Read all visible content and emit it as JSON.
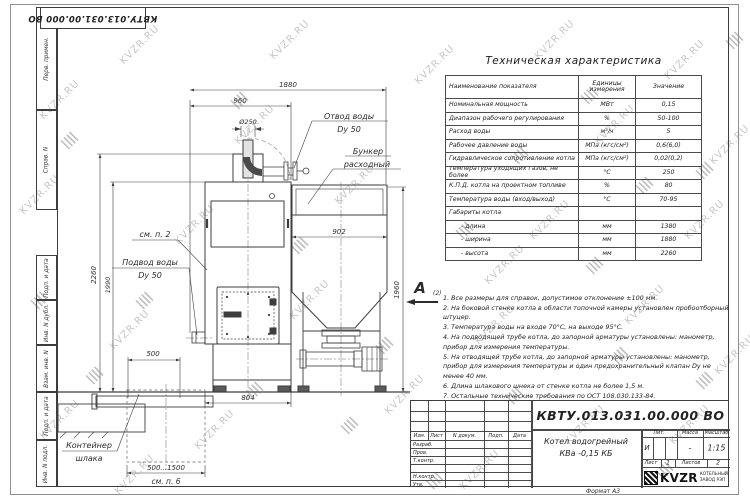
{
  "frame": {
    "doc_number_top": "КВТУ.013.031.00.000 ВО",
    "left_strip_top": [
      "Перв. примен.",
      "Справ. N"
    ],
    "left_strip_bottom": [
      "Подп. и дата",
      "Инв. N дубл.",
      "Взам. инв. N",
      "Подп. и дата",
      "Инв. N подл."
    ],
    "format_label": "Формат А3"
  },
  "watermark": {
    "text": "KVZR.RU"
  },
  "spec_table": {
    "title": "Техническая характеристика",
    "headers": {
      "name": "Наименование показателя",
      "unit": "Единицы измерения",
      "value": "Значение"
    },
    "rows": [
      {
        "name": "Номинальная мощность",
        "unit": "МВт",
        "value": "0,15"
      },
      {
        "name": "Диапазон рабочего регулирования",
        "unit": "%",
        "value": "50-100"
      },
      {
        "name": "Расход воды",
        "unit": "м³/ч",
        "value": "5"
      },
      {
        "name": "Рабочее давление воды",
        "unit": "МПа (кгс/см²)",
        "value": "0,6(6,0)"
      },
      {
        "name": "Гидравлическое сопротивление котла",
        "unit": "МПа (кгс/см²)",
        "value": "0,02(0,2)"
      },
      {
        "name": "Температура уходящих газов, не более",
        "unit": "°С",
        "value": "250"
      },
      {
        "name": "К.П.Д. котла на проектном топливе",
        "unit": "%",
        "value": "80"
      },
      {
        "name": "Температура воды (вход/выход)",
        "unit": "°С",
        "value": "70-95"
      },
      {
        "name": "Габариты котла",
        "unit": "",
        "value": ""
      },
      {
        "name": "- длина",
        "unit": "мм",
        "value": "1380"
      },
      {
        "name": "- ширина",
        "unit": "мм",
        "value": "1880"
      },
      {
        "name": "- высота",
        "unit": "мм",
        "value": "2260"
      }
    ]
  },
  "notes": {
    "items": [
      "1.  Все размеры для справок, допустимое отклонение  ±100 мм.",
      "2.  На боковой стенке котла в области топочной камеры установлен пробоотборный штуцер.",
      "3.  Температура воды на входе  70°С, на выходе  95°С.",
      "4.  На подводящей трубе котла, до запорной арматуры установлены: манометр, прибор для измерения температуры.",
      "5.  На отводящей трубе котла, до запорной арматуры установлены: манометр, прибор для измерения температуры и один предохранительный клапан Dy не менее  40 мм.",
      "6.  Длина шлакового шнека от стенке котла не более  1,5 м.",
      "7.  Остальные технические требования по ОСТ  108.030.133-84."
    ]
  },
  "view_marker": {
    "letter": "А",
    "sub": "(2)"
  },
  "drawing": {
    "dims": {
      "overall_length": "1880",
      "top_length": "960",
      "chimney_dia": "Ø250",
      "bunker_width": "902",
      "bunker_height": "1960",
      "overall_height": "2260",
      "boiler_height": "1990",
      "container_width": "500",
      "boiler_base_length": "804",
      "container_range": "500...1500"
    },
    "labels": {
      "outlet_line1": "Отвод воды",
      "outlet_line2": "Dy 50",
      "bunker_line1": "Бункер",
      "bunker_line2": "расходный",
      "see_note_2": "см. п. 2",
      "inlet_line1": "Подвод воды",
      "inlet_line2": "Dy 50",
      "container_line1": "Контейнер",
      "container_line2": "шлака",
      "see_note_6": "см. п. 6"
    }
  },
  "title_block": {
    "doc_number": "КВТУ.013.031.00.000  ВО",
    "product_line1": "Котел водогрейный",
    "product_line2": "КВа -0,15  КБ",
    "cols": {
      "izm": "Изм.",
      "list": "Лист",
      "n_doc": "N докум.",
      "podp": "Подп.",
      "data": "Дата"
    },
    "rows": [
      "Разраб.",
      "Пров.",
      "Т.контр.",
      "",
      "Н.контр.",
      "Утв."
    ],
    "lit_label": "Лит.",
    "mass_label": "Масса",
    "scale_label": "Масштаб",
    "lit_value": "И",
    "mass_value": "-",
    "scale_value": "1:15",
    "sheet_label": "Лист",
    "sheet_value": "1",
    "sheets_label": "Листов",
    "sheets_value": "2",
    "logo_text": "KVZR",
    "company_line1": "КОТЕЛЬНЫЙ",
    "company_line2": "ЗАВОД РЭП"
  }
}
